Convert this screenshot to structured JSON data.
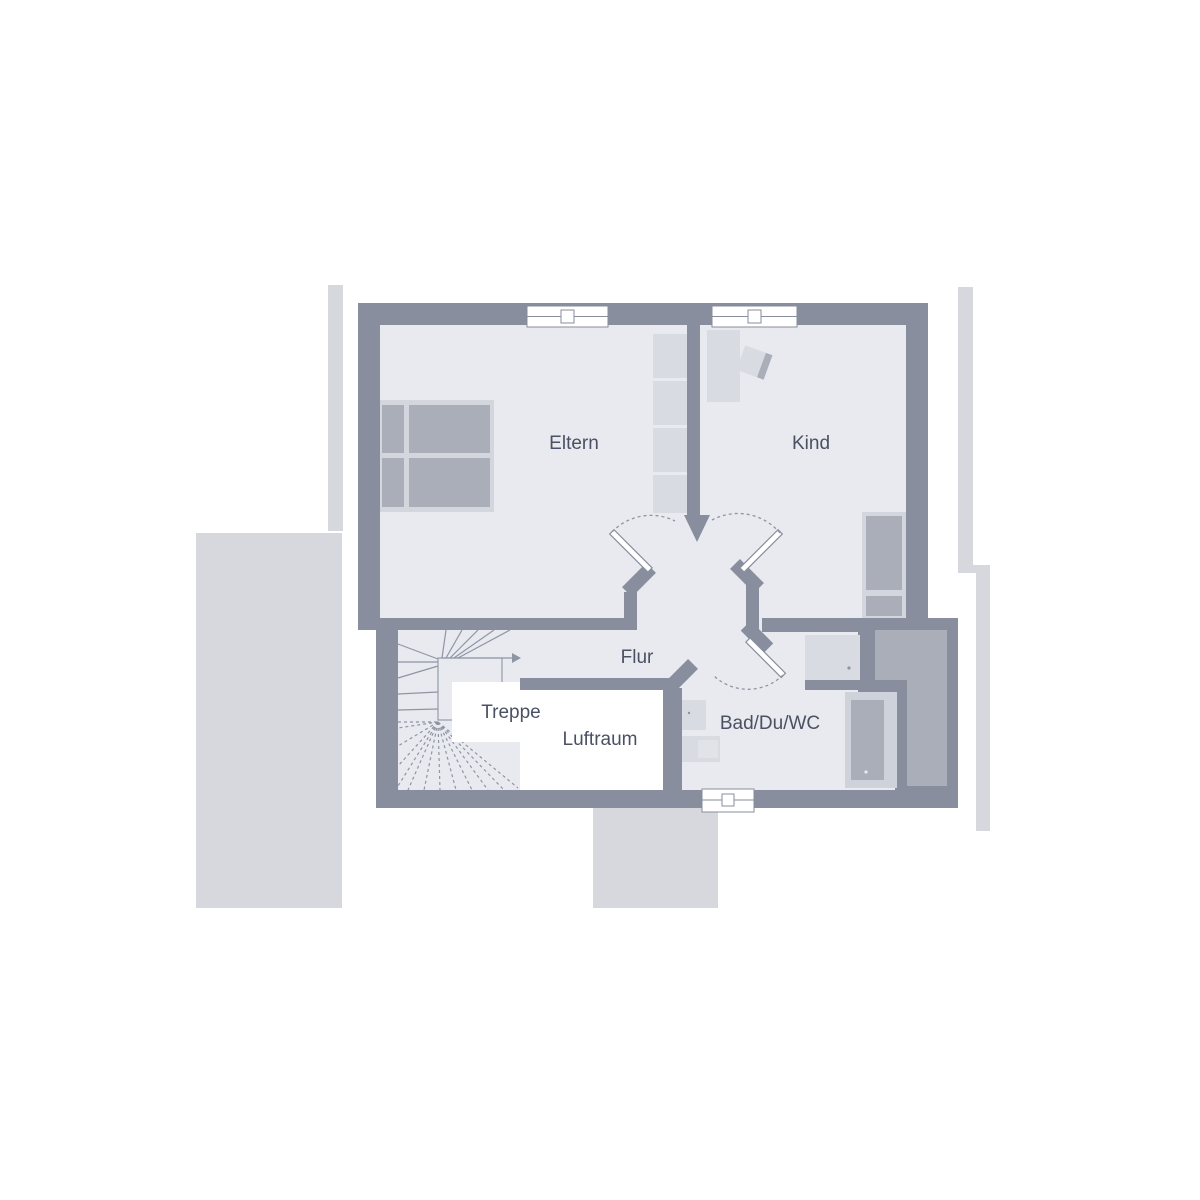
{
  "plan": {
    "type": "floor-plan-upper-storey",
    "labels": {
      "parents_room": "Eltern",
      "child_room": "Kind",
      "hallway": "Flur",
      "stairs": "Treppe",
      "void": "Luftraum",
      "bathroom": "Bad/Du/WC"
    },
    "symbols": [
      "window-symbol",
      "door-swing-arc",
      "stair-direction-arrow"
    ]
  },
  "colors": {
    "wall": "#888e9e",
    "floor": "#e8eaef",
    "outer": "#d6d8de",
    "void": "#ffffff",
    "furn-frame": "#d3d6dd",
    "furn-fill": "#a9aeb9",
    "furn-light": "#d8dbe1",
    "line": "#8e95a5",
    "text": "#4a5162"
  }
}
